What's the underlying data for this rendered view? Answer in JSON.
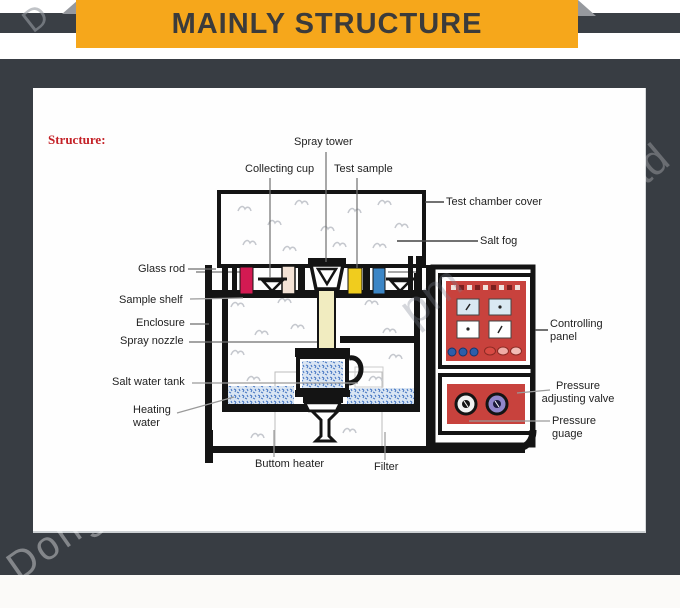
{
  "banner": {
    "title": "MAINLY STRUCTURE",
    "bg_color": "#f6a71b",
    "text_color": "#3b3b3b"
  },
  "page": {
    "background_dark": "#383d43",
    "panel_bg": "#fefefe",
    "bottom_strip": "#fbfaf8"
  },
  "diagram": {
    "heading": "Structure:",
    "heading_color": "#c42127",
    "labels": {
      "spray_tower": "Spray tower",
      "collecting_cup": "Collecting cup",
      "test_sample": "Test sample",
      "test_chamber_cover": "Test chamber cover",
      "salt_fog": "Salt fog",
      "glass_rod": "Glass rod",
      "sample_shelf": "Sample shelf",
      "enclosure": "Enclosure",
      "spray_nozzle": "Spray nozzle",
      "salt_water_tank": "Salt water tank",
      "heating_water": "Heating water",
      "buttom_heater": "Buttom heater",
      "filter": "Filter",
      "controlling_panel": "Controlling panel",
      "pressure_adjusting_valve": "Pressure adjusting valve",
      "pressure_guage": "Pressure guage"
    },
    "colors": {
      "outline": "#141414",
      "sample_red": "#d31a52",
      "sample_cream": "#f3e2d5",
      "sample_yellow": "#f0cc1e",
      "sample_blue": "#3c86c6",
      "spray_column_cream": "#f1ecc0",
      "panel_red": "#c8423d",
      "display_blue": "#d9e8f2",
      "button_blue": "#2e5ea9",
      "button_pink": "#f0aca6",
      "button_red": "#d94a43",
      "knob_purple": "#9187cb",
      "water_base": "#d9e5f3",
      "water_speckle": "#4a79c4",
      "fog_gray": "#c5c8ce"
    }
  },
  "watermark": {
    "fragments": {
      "top_left": "D",
      "center": "pm",
      "top_right": "td",
      "bottom_left": "Dong"
    }
  }
}
